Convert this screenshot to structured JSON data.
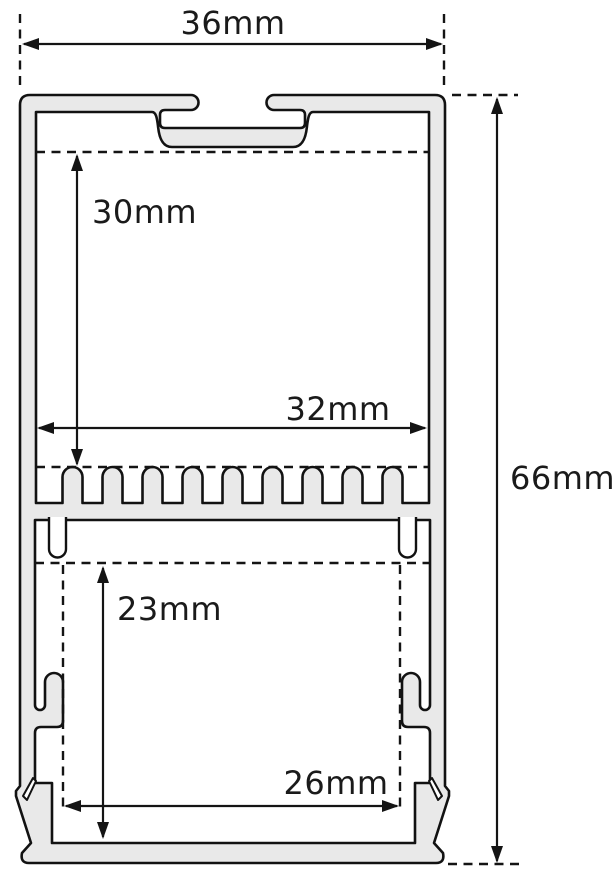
{
  "figure": {
    "type": "technical cross-section drawing",
    "subject": "aluminum LED strip profile with dimension annotations",
    "background_color": "#ffffff",
    "colors": {
      "aluminum_fill": "#e9e9e9",
      "outline": "#121212",
      "dimension_lines": "#141414",
      "label_text": "#1a1a1a"
    },
    "dimensions": [
      {
        "id": "outer-width",
        "label": "36mm",
        "orientation": "horizontal",
        "position": "top"
      },
      {
        "id": "outer-height",
        "label": "66mm",
        "orientation": "vertical",
        "position": "right"
      },
      {
        "id": "upper-cavity-height",
        "label": "30mm",
        "orientation": "vertical",
        "position": "upper-left-inside"
      },
      {
        "id": "upper-cavity-width",
        "label": "32mm",
        "orientation": "horizontal",
        "position": "middle-inside"
      },
      {
        "id": "lower-cavity-height",
        "label": "23mm",
        "orientation": "vertical",
        "position": "lower-left-inside"
      },
      {
        "id": "lower-cavity-width",
        "label": "26mm",
        "orientation": "horizontal",
        "position": "bottom-inside"
      }
    ]
  }
}
